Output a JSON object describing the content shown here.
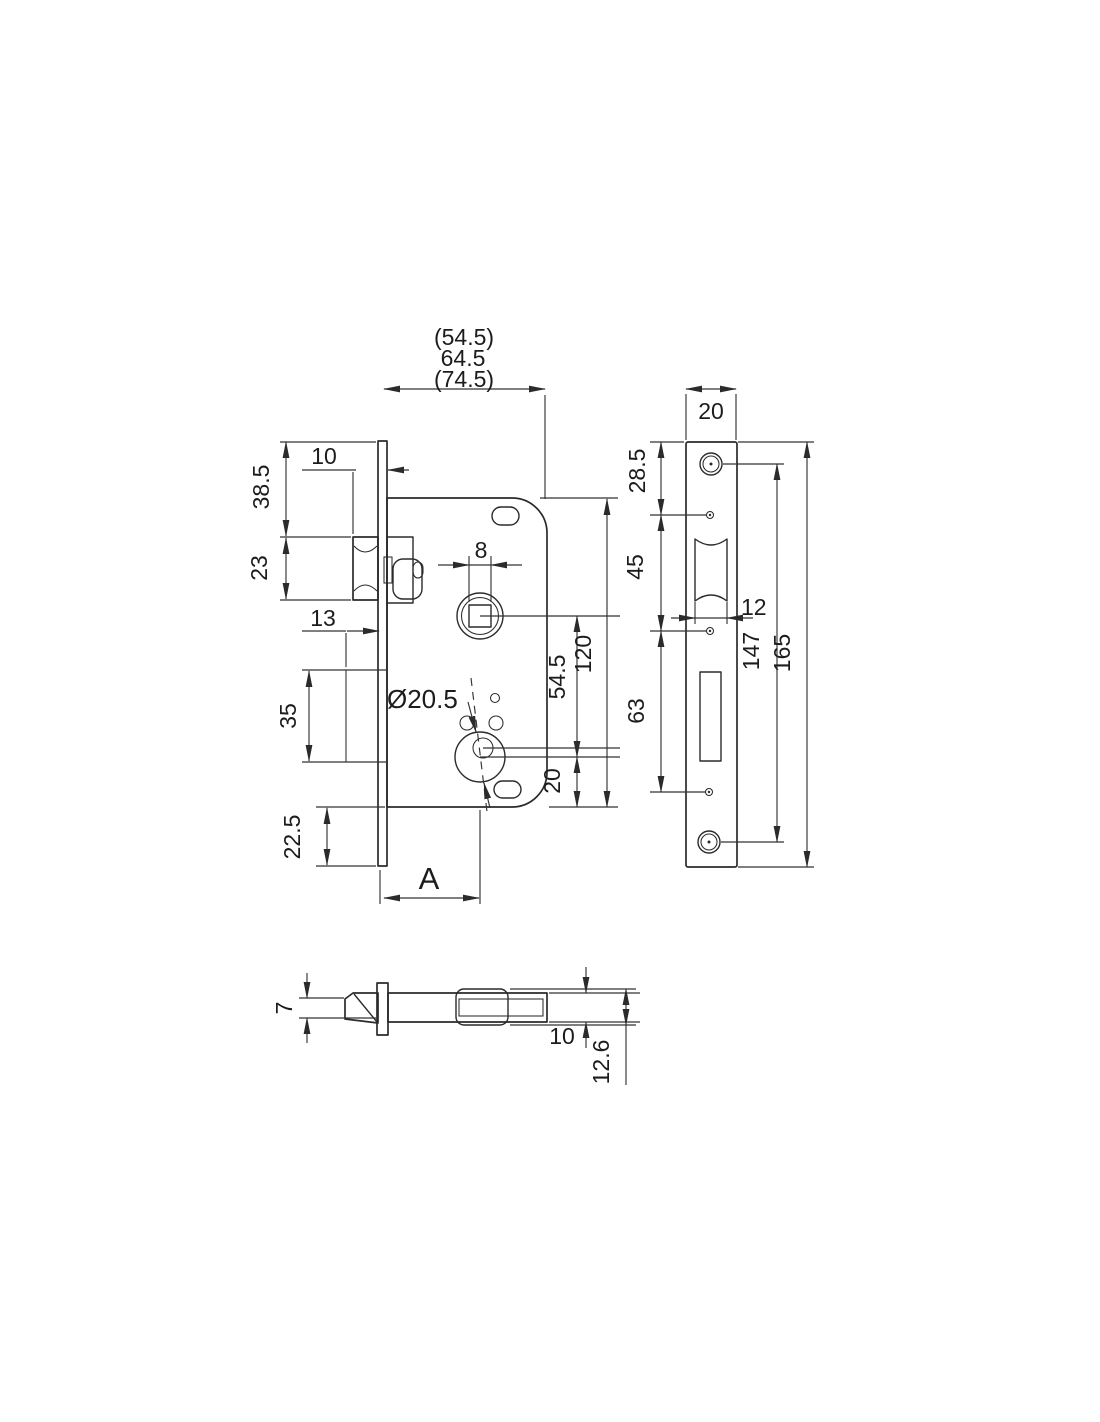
{
  "drawing": {
    "subject": "mortise-door-lock-dimensioned-technical-drawing",
    "colors": {
      "line": "#2b2b2b",
      "dimension_line": "#333333",
      "background": "#ffffff"
    },
    "views": {
      "front": "lock case front view",
      "faceplate": "strike / face plate view",
      "latch": "latch bolt side view"
    },
    "dims": {
      "case_depth_opt_small": "(54.5)",
      "case_depth": "64.5",
      "case_depth_opt_large": "(74.5)",
      "latch_protrusion": "10",
      "plate_top_to_latch": "38.5",
      "latch_height": "23",
      "deadbolt_offset": "13",
      "deadbolt_height": "35",
      "case_to_plate_bottom": "22.5",
      "backset": "A",
      "spindle_square": "8",
      "cylinder_diameter": "Ø20.5",
      "spindle_to_cylinder": "54.5",
      "case_height": "120",
      "cylinder_to_case_bottom": "20",
      "faceplate_width": "20",
      "plate_top_to_hole1": "28.5",
      "hole1_to_hole2": "45",
      "latch_cutout_width": "12",
      "hole2_to_hole3": "63",
      "screw_spacing": "147",
      "faceplate_height": "165",
      "latch_head_height": "7",
      "latch_body_height": "10",
      "latch_overall_height": "12.6"
    }
  }
}
